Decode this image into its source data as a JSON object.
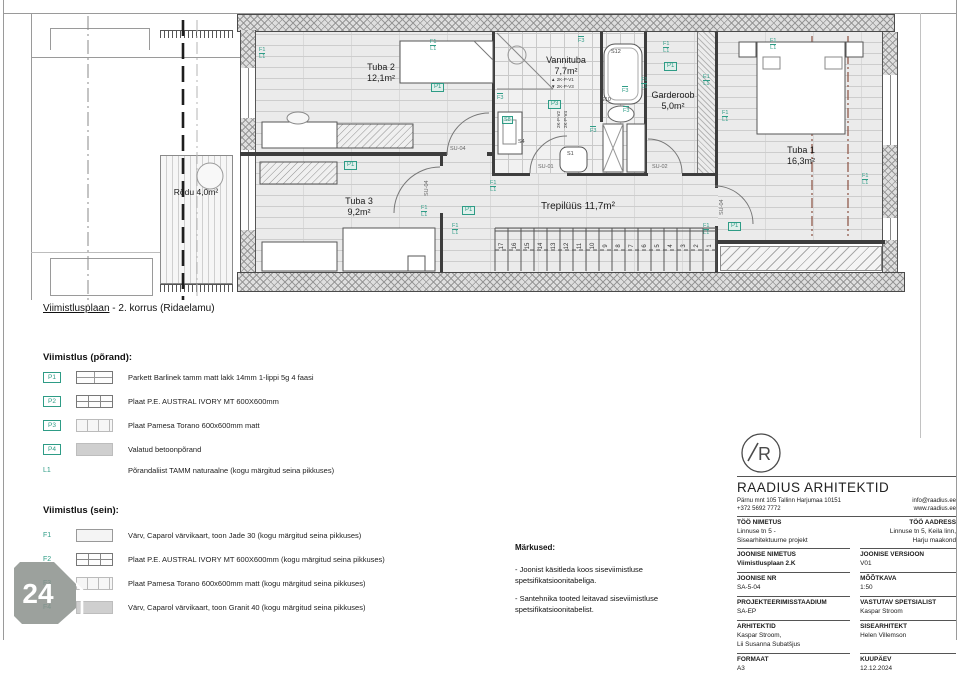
{
  "sheet": {
    "caption_underlined": "Viimistlusplaan",
    "caption_rest": " - 2. korrus (Ridaelamu)"
  },
  "plan": {
    "rooms": [
      {
        "n": "Tuba 2",
        "a": "12,1m²",
        "x": 381,
        "y": 62
      },
      {
        "n": "Vannituba",
        "a": "7,7m²",
        "x": 566,
        "y": 55
      },
      {
        "n": "Garderoob",
        "a": "5,0m²",
        "x": 673,
        "y": 90
      },
      {
        "n": "Tuba 1",
        "a": "16,3m²",
        "x": 801,
        "y": 145
      },
      {
        "n": "Tuba 3",
        "a": "9,2m²",
        "x": 359,
        "y": 196
      },
      {
        "n": "Trepilüüs 11,7m²",
        "x": 578,
        "y": 202,
        "cls": "lg"
      },
      {
        "n": "Rõdu 4,0m²",
        "x": 196,
        "y": 187,
        "cls": "sm"
      }
    ],
    "tags": [
      {
        "t": "P1",
        "x": 431,
        "y": 83
      },
      {
        "t": "P1",
        "x": 344,
        "y": 161
      },
      {
        "t": "P1",
        "x": 462,
        "y": 206
      },
      {
        "t": "P1",
        "x": 728,
        "y": 222
      },
      {
        "t": "P1",
        "x": 664,
        "y": 62
      },
      {
        "t": "P3",
        "x": 548,
        "y": 100
      }
    ],
    "overline_tags": [
      {
        "t": "F3",
        "x": 497,
        "y": 93
      },
      {
        "t": "F3",
        "x": 622,
        "y": 86
      },
      {
        "t": "F3",
        "x": 623,
        "y": 106
      },
      {
        "t": "F3",
        "x": 590,
        "y": 126
      },
      {
        "t": "F3",
        "x": 578,
        "y": 36
      }
    ],
    "pairs": [
      {
        "a": "F1",
        "b": "L1",
        "x": 259,
        "y": 47
      },
      {
        "a": "F1",
        "b": "L1",
        "x": 430,
        "y": 39
      },
      {
        "a": "F1",
        "b": "L1",
        "x": 452,
        "y": 223
      },
      {
        "a": "F1",
        "b": "L1",
        "x": 490,
        "y": 180
      },
      {
        "a": "F1",
        "b": "L1",
        "x": 663,
        "y": 41
      },
      {
        "a": "F1",
        "b": "L1",
        "x": 641,
        "y": 77
      },
      {
        "a": "E1",
        "b": "L1",
        "x": 703,
        "y": 74
      },
      {
        "a": "F1",
        "b": "L1",
        "x": 722,
        "y": 110
      },
      {
        "a": "F1",
        "b": "L1",
        "x": 770,
        "y": 38
      },
      {
        "a": "F1",
        "b": "L1",
        "x": 862,
        "y": 173
      },
      {
        "a": "F1",
        "b": "L1",
        "x": 703,
        "y": 223
      },
      {
        "a": "F1",
        "b": "L1",
        "x": 421,
        "y": 205
      }
    ],
    "fixtures": [
      {
        "t": "S12",
        "x": 611,
        "y": 49
      },
      {
        "t": "S10",
        "x": 601,
        "y": 97
      },
      {
        "t": "S1",
        "x": 567,
        "y": 151
      },
      {
        "t": "S8",
        "x": 502,
        "y": 116,
        "box": true
      },
      {
        "t": "S4",
        "x": 518,
        "y": 139
      }
    ],
    "doors": [
      {
        "t": "SU-04",
        "x": 450,
        "y": 146
      },
      {
        "t": "SU-01",
        "x": 538,
        "y": 164
      },
      {
        "t": "SU-02",
        "x": 652,
        "y": 164
      },
      {
        "t": "SU-04",
        "x": 424,
        "y": 196,
        "rot": true
      },
      {
        "t": "SU-04",
        "x": 719,
        "y": 215,
        "rot": true
      }
    ],
    "vents": [
      {
        "t": "▲ 2K-P-V1",
        "x": 551,
        "y": 77
      },
      {
        "t": "▼ 2K-P-V3",
        "x": 551,
        "y": 84
      },
      {
        "t": "2K-P-V2",
        "x": 556,
        "y": 128,
        "rot": true
      },
      {
        "t": "2K-P-V4",
        "x": 563,
        "y": 128,
        "rot": true
      }
    ],
    "stair_numbers": [
      "17",
      "16",
      "15",
      "14",
      "13",
      "12",
      "11",
      "10",
      "9",
      "8",
      "7",
      "6",
      "5",
      "4",
      "3",
      "2",
      "1"
    ]
  },
  "floor_section": {
    "title": "Viimistlus (põrand):",
    "rows": [
      {
        "code": "P1",
        "text": "Parkett Barlinek tamm matt lakk 14mm 1-lippi 5g 4 faasi"
      },
      {
        "code": "P2",
        "text": "Plaat P.E. AUSTRAL IVORY MT 600X600mm"
      },
      {
        "code": "P3",
        "text": "Plaat Pamesa Torano 600x600mm matt"
      },
      {
        "code": "P4",
        "text": "Valatud betoonpõrand"
      },
      {
        "code": "L1",
        "text": "Põrandaliist TAMM naturaalne (kogu märgitud seina pikkuses)"
      }
    ]
  },
  "wall_section": {
    "title": "Viimistlus (sein):",
    "rows": [
      {
        "code": "F1",
        "text": "Värv, Caparol värvikaart, toon Jade 30 (kogu märgitud seina pikkuses)"
      },
      {
        "code": "F2",
        "text": "Plaat P.E. AUSTRAL IVORY MT 600X600mm (kogu märgitud seina pikkuses)"
      },
      {
        "code": "F3",
        "text": "Plaat Pamesa Torano 600x600mm matt (kogu märgitud seina pikkuses)"
      },
      {
        "code": "F4",
        "text": "Värv, Caparol värvikaart, toon Granit 40 (kogu märgitud seina pikkuses)"
      }
    ]
  },
  "notes": {
    "title": "Märkused:",
    "items": [
      "- Joonist käsitleda koos siseviimistluse spetsifikatsioonitabeliga.",
      "- Santehnika tooted leitavad siseviimistluse spetsifikatsioonitabelist."
    ]
  },
  "titleblock": {
    "logo_letter": "R",
    "company": "RAADIUS ARHITEKTID",
    "address": "Pärnu mnt 105 Tallinn Harjumaa 10151",
    "phone": "+372 5692 7772",
    "email": "info@raadius.ee",
    "website": "www.raadius.ee",
    "too_nimetus_label": "TÖÖ NIMETUS",
    "too_nimetus_v1": "Linnuse tn 5 -",
    "too_nimetus_v2": "Sisearhitektuurne projekt",
    "too_aadress_label": "TÖÖ AADRESS",
    "too_aadress_v1": "Linnuse tn 5, Keila linn,",
    "too_aadress_v2": "Harju maakond",
    "joonise_nimetus_label": "JOONISE NIMETUS",
    "joonise_nimetus_value": "Viimistlusplaan 2.K",
    "joonise_versioon_label": "JOONISE VERSIOON",
    "joonise_versioon_value": "V01",
    "joonise_nr_label": "JOONISE NR",
    "joonise_nr_value": "SA-5-04",
    "mootkava_label": "MÕÕTKAVA",
    "mootkava_value": "1:50",
    "staadium_label": "PROJEKTEERIMISSTAADIUM",
    "staadium_value": "SA-EP",
    "vastutav_label": "VASTUTAV SPETSIALIST",
    "vastutav_value": "Kaspar Stroom",
    "arhitektid_label": "ARHITEKTID",
    "arhitektid_v1": "Kaspar Stroom,",
    "arhitektid_v2": "Lii Susanna Subatšjus",
    "sisearhitekt_label": "SISEARHITEKT",
    "sisearhitekt_value": "Helen Villemson",
    "formaat_label": "FORMAAT",
    "formaat_value": "A3",
    "kuupaev_label": "KUUPÄEV",
    "kuupaev_value": "12.12.2024"
  },
  "badge": {
    "value": "24"
  }
}
